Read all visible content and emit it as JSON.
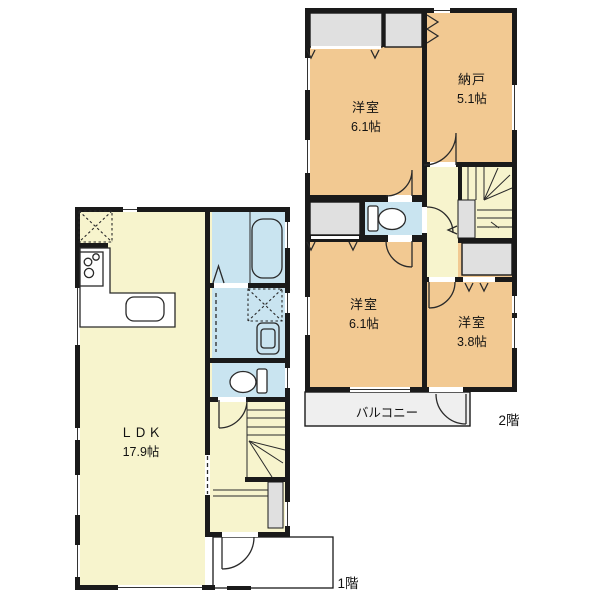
{
  "page": {
    "background": "#ffffff"
  },
  "colors": {
    "wall": "#1a1a1a",
    "floor_cream": "#f7f4cd",
    "room_tan": "#f2c992",
    "wet_blue": "#c9e4f0",
    "closet_gray": "#e0e0e0",
    "balcony_gray": "#efefef",
    "line": "#2a2a2a",
    "fixture_white": "#ffffff"
  },
  "floor1": {
    "floor_label": "1階",
    "ldk": {
      "name": "ＬＤＫ",
      "size": "17.9帖"
    }
  },
  "floor2": {
    "floor_label": "2階",
    "yoshitsu_top": {
      "name": "洋室",
      "size": "6.1帖"
    },
    "nando": {
      "name": "納戸",
      "size": "5.1帖"
    },
    "yoshitsu_bottom": {
      "name": "洋室",
      "size": "6.1帖"
    },
    "yoshitsu_small": {
      "name": "洋室",
      "size": "3.8帖"
    },
    "balcony": {
      "name": "バルコニー"
    }
  }
}
